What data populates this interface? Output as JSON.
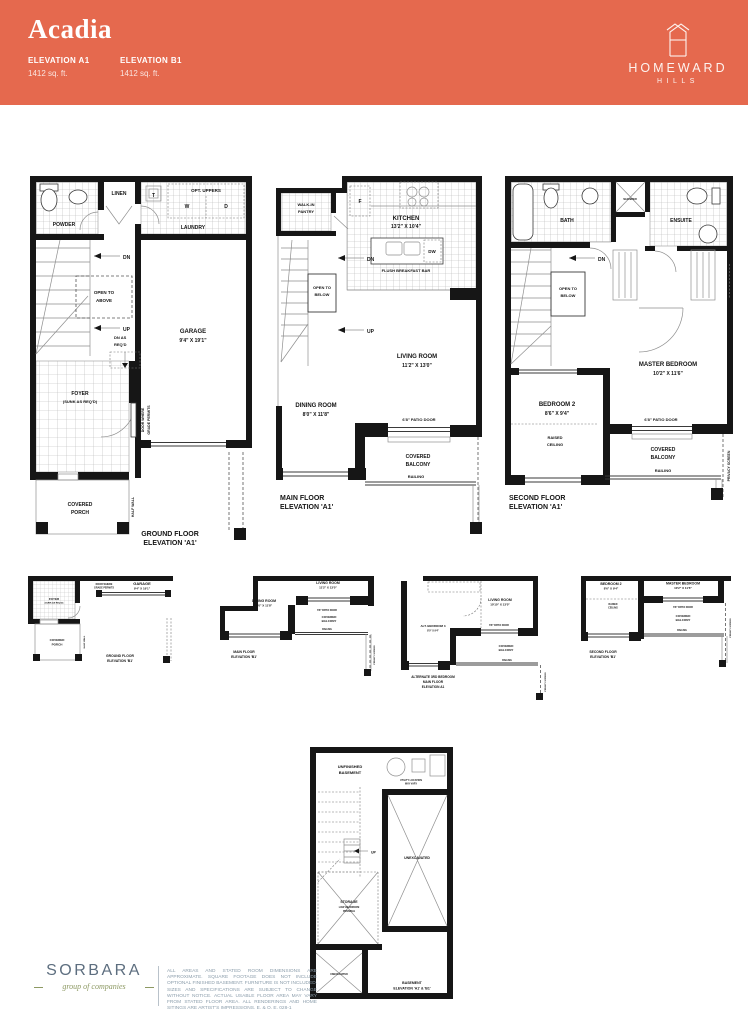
{
  "header": {
    "title": "Acadia",
    "bg_color": "#E5694E",
    "elevations": [
      {
        "label": "ELEVATION A1",
        "area": "1412 sq. ft."
      },
      {
        "label": "ELEVATION B1",
        "area": "1412 sq. ft."
      }
    ],
    "brand": {
      "name": "HOMEWARD",
      "sub": "HILLS"
    }
  },
  "plans": {
    "ground_a1": {
      "powder": "POWDER",
      "linen": "LINEN",
      "t": "T",
      "w": "W",
      "d": "D",
      "opt_uppers": "OPT. UPPERS",
      "laundry": "LAUNDRY",
      "dn": "DN",
      "up": "UP",
      "open_above_1": "OPEN TO",
      "open_above_2": "ABOVE",
      "dn_req_1": "DN AS",
      "dn_req_2": "REQ'D",
      "garage": "GARAGE",
      "garage_dims": "9'4\" X 19'1\"",
      "foyer": "FOYER",
      "foyer_note": "(SUNK AS REQ'D)",
      "door_grade_1": "DOOR WHERE",
      "door_grade_2": "GRADE PERMITS",
      "covered": "COVERED",
      "porch": "PORCH",
      "half_wall": "HALF WALL",
      "caption_1": "GROUND FLOOR",
      "caption_2": "ELEVATION 'A1'"
    },
    "main_a1": {
      "pantry_1": "WALK-IN",
      "pantry_2": "PANTRY",
      "fridge": "F",
      "kitchen": "KITCHEN",
      "kitchen_dims": "13'2\" X 10'4\"",
      "dw": "DW",
      "breakfast_bar": "FLUSH BREAKFAST BAR",
      "dn": "DN",
      "up": "UP",
      "open_below_1": "OPEN TO",
      "open_below_2": "BELOW",
      "living": "LIVING ROOM",
      "living_dims": "11'2\" X 13'0\"",
      "dining": "DINING ROOM",
      "dining_dims": "8'0\" X 11'8\"",
      "patio_door": "6'8\" PATIO DOOR",
      "covered": "COVERED",
      "balcony": "BALCONY",
      "railing": "RAILING",
      "privacy": "PRIVACY SCREEN",
      "caption_1": "MAIN FLOOR",
      "caption_2": "ELEVATION 'A1'"
    },
    "second_a1": {
      "bath": "BATH",
      "shower": "SHOWER",
      "ensuite": "ENSUITE",
      "dn": "DN",
      "open_below_1": "OPEN TO",
      "open_below_2": "BELOW",
      "master": "MASTER BEDROOM",
      "master_dims": "10'2\" X 11'6\"",
      "bedroom2": "BEDROOM 2",
      "bedroom2_dims": "8'6\" X 9'4\"",
      "raised_1": "RAISED",
      "raised_2": "CEILING",
      "patio_door": "6'8\" PATIO DOOR",
      "covered": "COVERED",
      "balcony": "BALCONY",
      "railing": "RAILING",
      "privacy": "PRIVACY SCREEN",
      "caption_1": "SECOND FLOOR",
      "caption_2": "ELEVATION 'A1'"
    },
    "ground_b1": {
      "door_grade_1": "DOOR WHERE",
      "door_grade_2": "GRADE PERMITS",
      "garage": "GARAGE",
      "garage_dims": "9'4\" X 19'1\"",
      "foyer": "FOYER",
      "foyer_note": "(SUNK AS REQ'D)",
      "covered": "COVERED",
      "porch": "PORCH",
      "half_wall": "HALF WALL",
      "caption_1": "GROUND FLOOR",
      "caption_2": "ELEVATION 'B1'"
    },
    "main_b1": {
      "living": "LIVING ROOM",
      "living_dims": "11'2\" X 13'0\"",
      "dining": "DINING ROOM",
      "dining_dims": "8'0\" X 11'8\"",
      "patio_door": "6'8\" PATIO DOOR",
      "covered": "COVERED",
      "balcony": "BALCONY",
      "railing": "RAILING",
      "privacy": "PRIVACY SCREEN",
      "caption_1": "MAIN FLOOR",
      "caption_2": "ELEVATION 'B1'"
    },
    "alt_bedroom": {
      "living": "LIVING ROOM",
      "living_dims": "10'10\" X 13'0\"",
      "alt_bed": "ALT. BEDROOM 3",
      "alt_bed_dims": "8'0\" X 9'4\"",
      "patio_door": "6'8\" PATIO DOOR",
      "covered": "COVERED",
      "balcony": "BALCONY",
      "railing": "RAILING",
      "privacy": "PRIVACY SCREEN",
      "caption_1": "ALTERNATE 3RD BEDROOM",
      "caption_2": "MAIN FLOOR",
      "caption_3": "ELEVATION A1"
    },
    "second_b1": {
      "bedroom2": "BEDROOM 2",
      "bedroom2_dims": "8'6\" X 9'4\"",
      "master": "MASTER BEDROOM",
      "master_dims": "10'2\" X 11'6\"",
      "raised_1": "RAISED",
      "raised_2": "CEILING",
      "patio_door": "6'8\" PATIO DOOR",
      "covered": "COVERED",
      "balcony": "BALCONY",
      "railing": "RAILING",
      "privacy": "PRIVACY SCREEN",
      "caption_1": "SECOND FLOOR",
      "caption_2": "ELEVATION 'B1'"
    },
    "basement": {
      "unfinished_1": "UNFINISHED",
      "unfinished_2": "BASEMENT",
      "utility_1": "UTILITY LOCATION",
      "utility_2": "MAY VARY",
      "up": "UP",
      "unexcavated": "UNEXCAVATED",
      "storage_1": "STORAGE",
      "storage_2": "LOW HEADROOM",
      "storage_3": "POSSIBLE",
      "unexcavated_2": "UNEXCAVATED",
      "caption_1": "BASEMENT",
      "caption_2": "ELEVATION 'A1' & 'B1'"
    }
  },
  "footer": {
    "logo_name": "SORBARA",
    "logo_sub": "group of companies",
    "fine_print": "ALL AREAS AND STATED ROOM DIMENSIONS ARE APPROXIMATE. SQUARE FOOTAGE DOES NOT INCLUDE OPTIONAL FINISHED BASEMENT. FURNITURE IS NOT INCLUDED. SIZES AND SPECIFICATIONS ARE SUBJECT TO CHANGE WITHOUT NOTICE. ACTUAL USABLE FLOOR AREA MAY VARY FROM STATED FLOOR AREA. ALL RENDERINGS AND HOME SITINGS ARE ARTIST'S IMPRESSIONS. E. & O. E.  028-1"
  }
}
